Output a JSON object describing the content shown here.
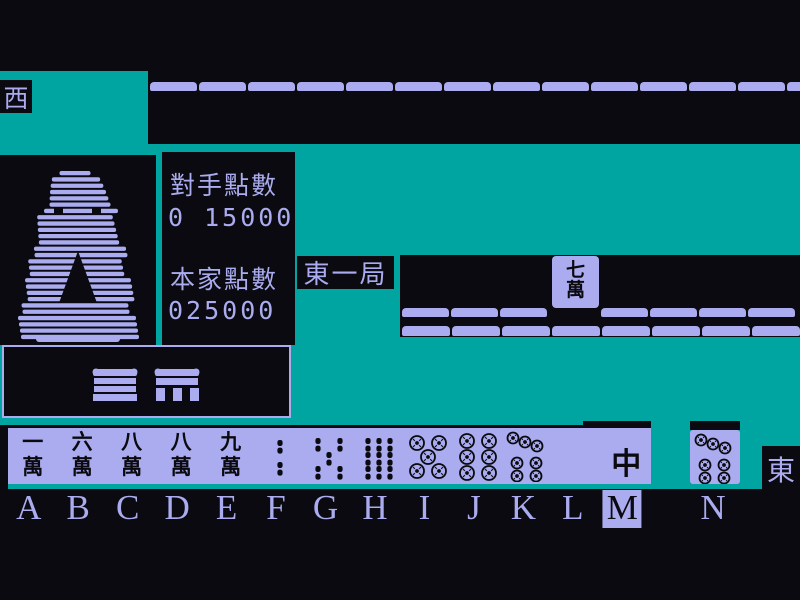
{
  "palette": {
    "background": "#0a0a10",
    "felt_green": "#00a5a1",
    "tile_lavender": "#abacef",
    "tile_ink": "#0a0a10"
  },
  "winds": {
    "left_seat": "西",
    "self_seat": "東"
  },
  "round_label": "東一局",
  "scoreboard": {
    "opponent_label": "對手點數",
    "opponent_value": "0 15000",
    "self_label": "本家點數",
    "self_value": "025000"
  },
  "discard": {
    "tile_label": "七萬"
  },
  "opponent_row": {
    "tile_count": 14
  },
  "wall": {
    "row1_left_count": 3,
    "row1_right_count": 4,
    "row2_count": 8
  },
  "hand": {
    "selected_key": "M",
    "tiles": [
      {
        "key": "A",
        "kind": "man",
        "label": "一萬"
      },
      {
        "key": "B",
        "kind": "man",
        "label": "六萬"
      },
      {
        "key": "C",
        "kind": "man",
        "label": "八萬"
      },
      {
        "key": "D",
        "kind": "man",
        "label": "八萬"
      },
      {
        "key": "E",
        "kind": "man",
        "label": "九萬"
      },
      {
        "key": "F",
        "kind": "sou",
        "value": 2,
        "label": "2索"
      },
      {
        "key": "G",
        "kind": "sou",
        "value": 5,
        "label": "5索"
      },
      {
        "key": "H",
        "kind": "sou",
        "value": 9,
        "label": "9索"
      },
      {
        "key": "I",
        "kind": "pin",
        "value": 5,
        "label": "5筒"
      },
      {
        "key": "J",
        "kind": "pin",
        "value": 6,
        "label": "6筒"
      },
      {
        "key": "K",
        "kind": "pin",
        "value": 7,
        "label": "7筒"
      },
      {
        "key": "L",
        "kind": "blank",
        "label": "白"
      },
      {
        "key": "M",
        "kind": "honor",
        "label": "中"
      }
    ],
    "drawn_tile": {
      "key": "N",
      "kind": "pin",
      "value": 7,
      "label": "7筒"
    }
  }
}
